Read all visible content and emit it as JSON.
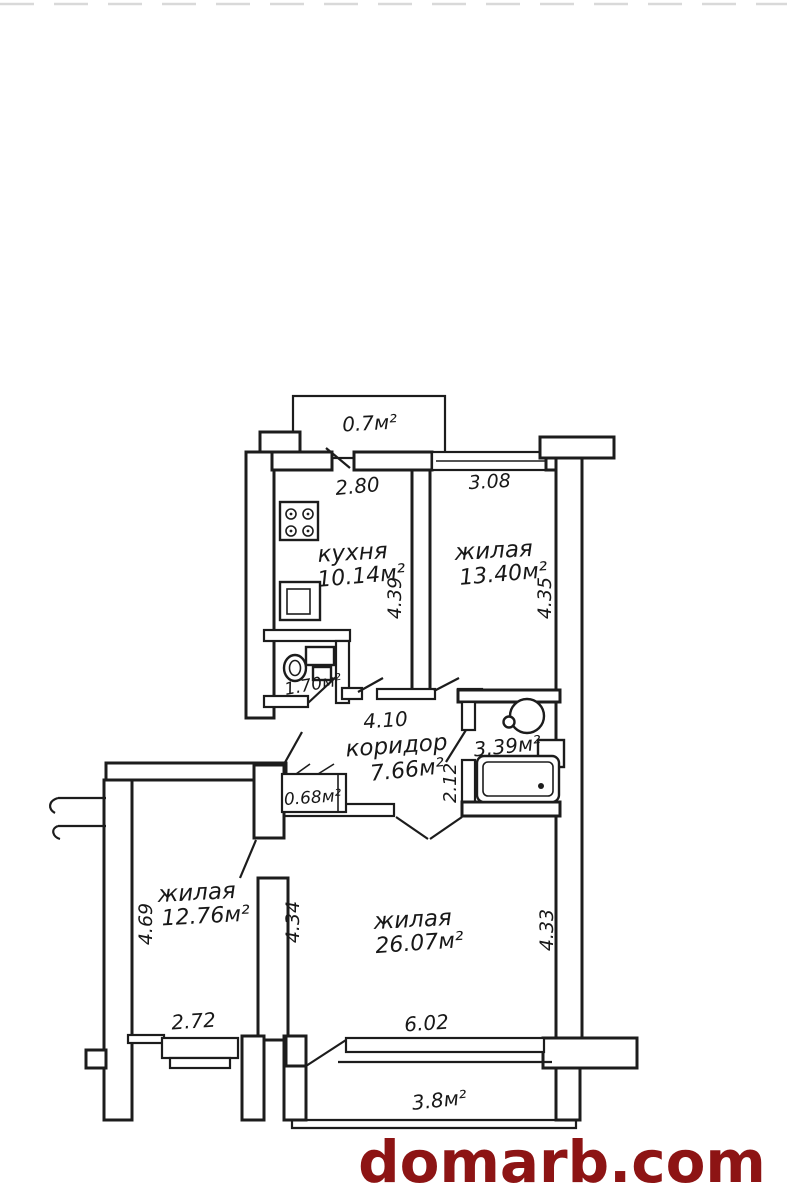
{
  "watermark": {
    "text": "domarb.com",
    "color": "#8d1414"
  },
  "icons": {
    "stove": "stove-icon",
    "kitchen_sink": "sink-icon",
    "toilet": "toilet-icon",
    "washbasin": "washbasin-icon",
    "water_heater": "water-heater-icon",
    "bathtub": "bathtub-icon"
  },
  "plan": {
    "balcony_top": {
      "area": "0.7м²"
    },
    "kitchen": {
      "name": "кухня",
      "area": "10.14м²",
      "width": "2.80",
      "height": "4.39"
    },
    "room_1": {
      "name": "жилая",
      "area": "13.40м²",
      "width": "3.08",
      "height": "4.35"
    },
    "wc": {
      "area": "1.70м²"
    },
    "corridor": {
      "name": "коридор",
      "area": "7.66м²",
      "width": "4.10",
      "height": "2.12"
    },
    "bathroom": {
      "area": "3.39м²"
    },
    "closet": {
      "area": "0.68м²"
    },
    "room_2": {
      "name": "жилая",
      "area": "12.76м²",
      "width": "2.72",
      "height": "4.69"
    },
    "room_3": {
      "name": "жилая",
      "area": "26.07м²",
      "width": "6.02",
      "height_left": "4.34",
      "height_right": "4.33"
    },
    "balcony_bottom": {
      "area": "3.8м²"
    }
  }
}
